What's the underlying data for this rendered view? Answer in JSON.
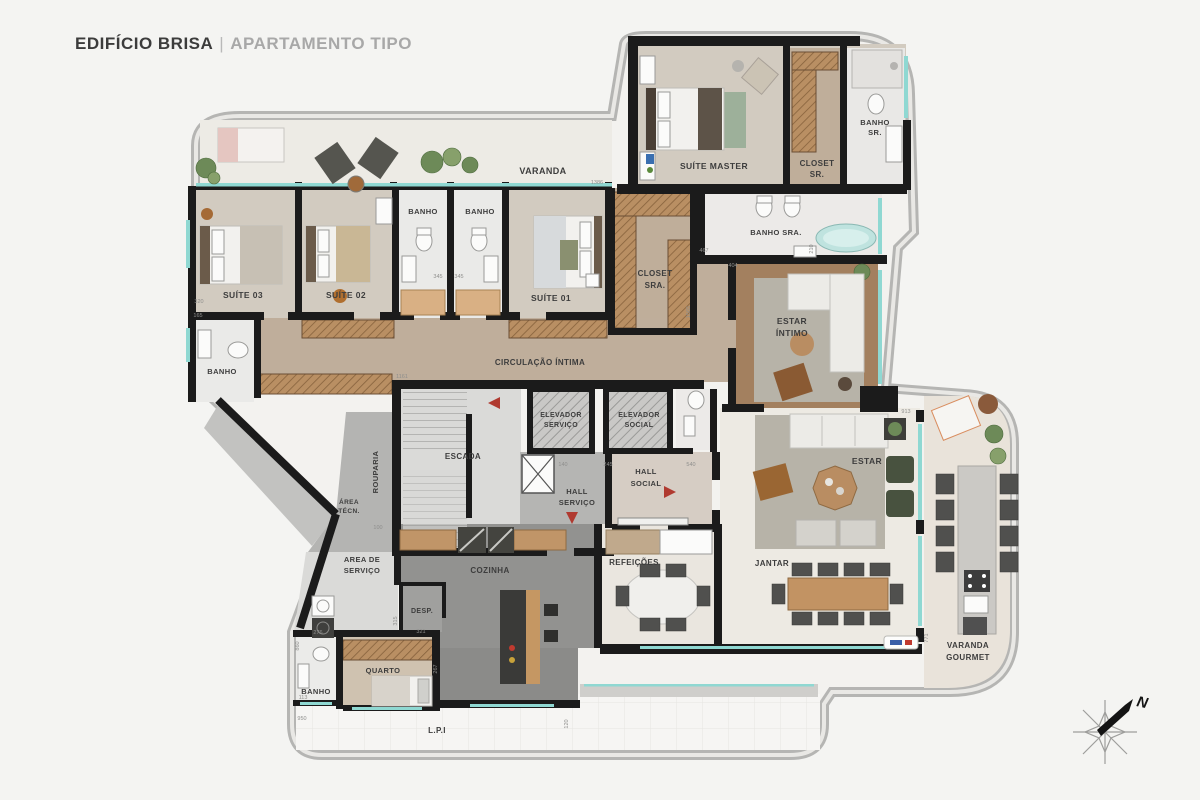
{
  "title": {
    "primary": "EDIFÍCIO BRISA",
    "separator": "|",
    "secondary": "APARTAMENTO TIPO"
  },
  "compass": {
    "north_label": "N"
  },
  "colors": {
    "wall": "#1b1b1b",
    "window": "#8fd8d2",
    "wood_floor": "#bfae9b",
    "bedroom_floor": "#d2cbc0",
    "bath_floor": "#eaeae8",
    "kitchen_floor": "#929290",
    "social_floor": "#edeae3",
    "wardrobe": "#b98f63",
    "label": "#3d3d3d",
    "door_arrow": "#b03a30",
    "outline_band": "#b9b9b9"
  },
  "plan": {
    "room_labels": [
      {
        "id": "varanda",
        "t": "VARANDA",
        "x": 543,
        "y": 174,
        "fs": 9
      },
      {
        "id": "suite-03",
        "t": "SUÍTE 03",
        "x": 243,
        "y": 298,
        "fs": 8.5
      },
      {
        "id": "suite-02",
        "t": "SUÍTE 02",
        "x": 346,
        "y": 298,
        "fs": 8.5
      },
      {
        "id": "banho-a",
        "t": "BANHO",
        "x": 423,
        "y": 214,
        "fs": 7.5
      },
      {
        "id": "banho-b",
        "t": "BANHO",
        "x": 480,
        "y": 214,
        "fs": 7.5
      },
      {
        "id": "suite-01",
        "t": "SUÍTE 01",
        "x": 551,
        "y": 301,
        "fs": 8.5
      },
      {
        "id": "closet-sra-1",
        "t": "CLOSET",
        "x": 655,
        "y": 276,
        "fs": 8
      },
      {
        "id": "closet-sra-2",
        "t": "SRA.",
        "x": 655,
        "y": 288,
        "fs": 8
      },
      {
        "id": "suite-master",
        "t": "SUÍTE MASTER",
        "x": 714,
        "y": 169,
        "fs": 8.5
      },
      {
        "id": "closet-sr-1",
        "t": "CLOSET",
        "x": 817,
        "y": 166,
        "fs": 8
      },
      {
        "id": "closet-sr-2",
        "t": "SR.",
        "x": 817,
        "y": 177,
        "fs": 8
      },
      {
        "id": "banho-sr-1",
        "t": "BANHO",
        "x": 875,
        "y": 125,
        "fs": 7.5
      },
      {
        "id": "banho-sr-2",
        "t": "SR.",
        "x": 875,
        "y": 135,
        "fs": 7.5
      },
      {
        "id": "banho-sra",
        "t": "BANHO SRA.",
        "x": 776,
        "y": 235,
        "fs": 7.5
      },
      {
        "id": "banho-s3",
        "t": "BANHO",
        "x": 222,
        "y": 374,
        "fs": 7.5
      },
      {
        "id": "circulacao",
        "t": "CIRCULAÇÃO ÍNTIMA",
        "x": 540,
        "y": 365,
        "fs": 8
      },
      {
        "id": "estar-intimo-1",
        "t": "ESTAR",
        "x": 792,
        "y": 324,
        "fs": 8.5
      },
      {
        "id": "estar-intimo-2",
        "t": "ÍNTIMO",
        "x": 792,
        "y": 336,
        "fs": 8.5
      },
      {
        "id": "escada",
        "t": "ESCADA",
        "x": 463,
        "y": 459,
        "fs": 8
      },
      {
        "id": "elev-serv-1",
        "t": "ELEVADOR",
        "x": 561,
        "y": 417,
        "fs": 7
      },
      {
        "id": "elev-serv-2",
        "t": "SERVIÇO",
        "x": 561,
        "y": 427,
        "fs": 7
      },
      {
        "id": "elev-soc-1",
        "t": "ELEVADOR",
        "x": 639,
        "y": 417,
        "fs": 7
      },
      {
        "id": "elev-soc-2",
        "t": "SOCIAL",
        "x": 639,
        "y": 427,
        "fs": 7
      },
      {
        "id": "hall-serv-1",
        "t": "HALL",
        "x": 577,
        "y": 494,
        "fs": 7.5
      },
      {
        "id": "hall-serv-2",
        "t": "SERVIÇO",
        "x": 577,
        "y": 505,
        "fs": 7.5
      },
      {
        "id": "hall-soc-1",
        "t": "HALL",
        "x": 646,
        "y": 474,
        "fs": 7.5
      },
      {
        "id": "hall-soc-2",
        "t": "SOCIAL",
        "x": 646,
        "y": 486,
        "fs": 7.5
      },
      {
        "id": "rouparia",
        "t": "ROUPARIA",
        "x": 378,
        "y": 472,
        "fs": 7.5,
        "r": -90
      },
      {
        "id": "area-tecn-1",
        "t": "ÁREA",
        "x": 349,
        "y": 504,
        "fs": 6.5
      },
      {
        "id": "area-tecn-2",
        "t": "TÉCN.",
        "x": 349,
        "y": 513,
        "fs": 6.5
      },
      {
        "id": "area-serv-1",
        "t": "AREA DE",
        "x": 362,
        "y": 562,
        "fs": 7.5
      },
      {
        "id": "area-serv-2",
        "t": "SERVIÇO",
        "x": 362,
        "y": 573,
        "fs": 7.5
      },
      {
        "id": "cozinha",
        "t": "COZINHA",
        "x": 490,
        "y": 573,
        "fs": 8
      },
      {
        "id": "desp",
        "t": "DESP.",
        "x": 422,
        "y": 613,
        "fs": 7
      },
      {
        "id": "quarto",
        "t": "QUARTO",
        "x": 383,
        "y": 673,
        "fs": 7.5
      },
      {
        "id": "banho-q",
        "t": "BANHO",
        "x": 316,
        "y": 694,
        "fs": 7.5
      },
      {
        "id": "refeicoes",
        "t": "REFEIÇÕES",
        "x": 634,
        "y": 565,
        "fs": 8
      },
      {
        "id": "estar",
        "t": "ESTAR",
        "x": 867,
        "y": 464,
        "fs": 8.5
      },
      {
        "id": "jantar",
        "t": "JANTAR",
        "x": 772,
        "y": 566,
        "fs": 8
      },
      {
        "id": "varanda-g-1",
        "t": "VARANDA",
        "x": 968,
        "y": 648,
        "fs": 8
      },
      {
        "id": "varanda-g-2",
        "t": "GOURMET",
        "x": 968,
        "y": 660,
        "fs": 8
      },
      {
        "id": "lpi",
        "t": "L.P.I",
        "x": 437,
        "y": 733,
        "fs": 8
      }
    ],
    "dimension_labels": [
      {
        "t": "1386",
        "x": 597,
        "y": 184
      },
      {
        "t": "1161",
        "x": 402,
        "y": 378
      },
      {
        "t": "140",
        "x": 563,
        "y": 466
      },
      {
        "t": "245",
        "x": 608,
        "y": 466
      },
      {
        "t": "540",
        "x": 691,
        "y": 466
      },
      {
        "t": "100",
        "x": 378,
        "y": 529
      },
      {
        "t": "320",
        "x": 199,
        "y": 303
      },
      {
        "t": "165",
        "x": 198,
        "y": 317
      },
      {
        "t": "345",
        "x": 438,
        "y": 278
      },
      {
        "t": "345",
        "x": 459,
        "y": 278
      },
      {
        "t": "404",
        "x": 733,
        "y": 267
      },
      {
        "t": "913",
        "x": 906,
        "y": 413
      },
      {
        "t": "467",
        "x": 704,
        "y": 252
      },
      {
        "t": "210",
        "x": 813,
        "y": 249,
        "r": -90
      },
      {
        "t": "771",
        "x": 928,
        "y": 638,
        "r": -90
      },
      {
        "t": "860",
        "x": 299,
        "y": 646,
        "r": -90
      },
      {
        "t": "950",
        "x": 302,
        "y": 720
      },
      {
        "t": "276",
        "x": 318,
        "y": 634
      },
      {
        "t": "113",
        "x": 303,
        "y": 699
      },
      {
        "t": "315",
        "x": 397,
        "y": 621,
        "r": -90
      },
      {
        "t": "321",
        "x": 421,
        "y": 633
      },
      {
        "t": "267",
        "x": 437,
        "y": 669,
        "r": -90
      },
      {
        "t": "120",
        "x": 568,
        "y": 724,
        "r": -90
      },
      {
        "t": "1565",
        "x": 690,
        "y": 312,
        "r": -90
      }
    ]
  }
}
